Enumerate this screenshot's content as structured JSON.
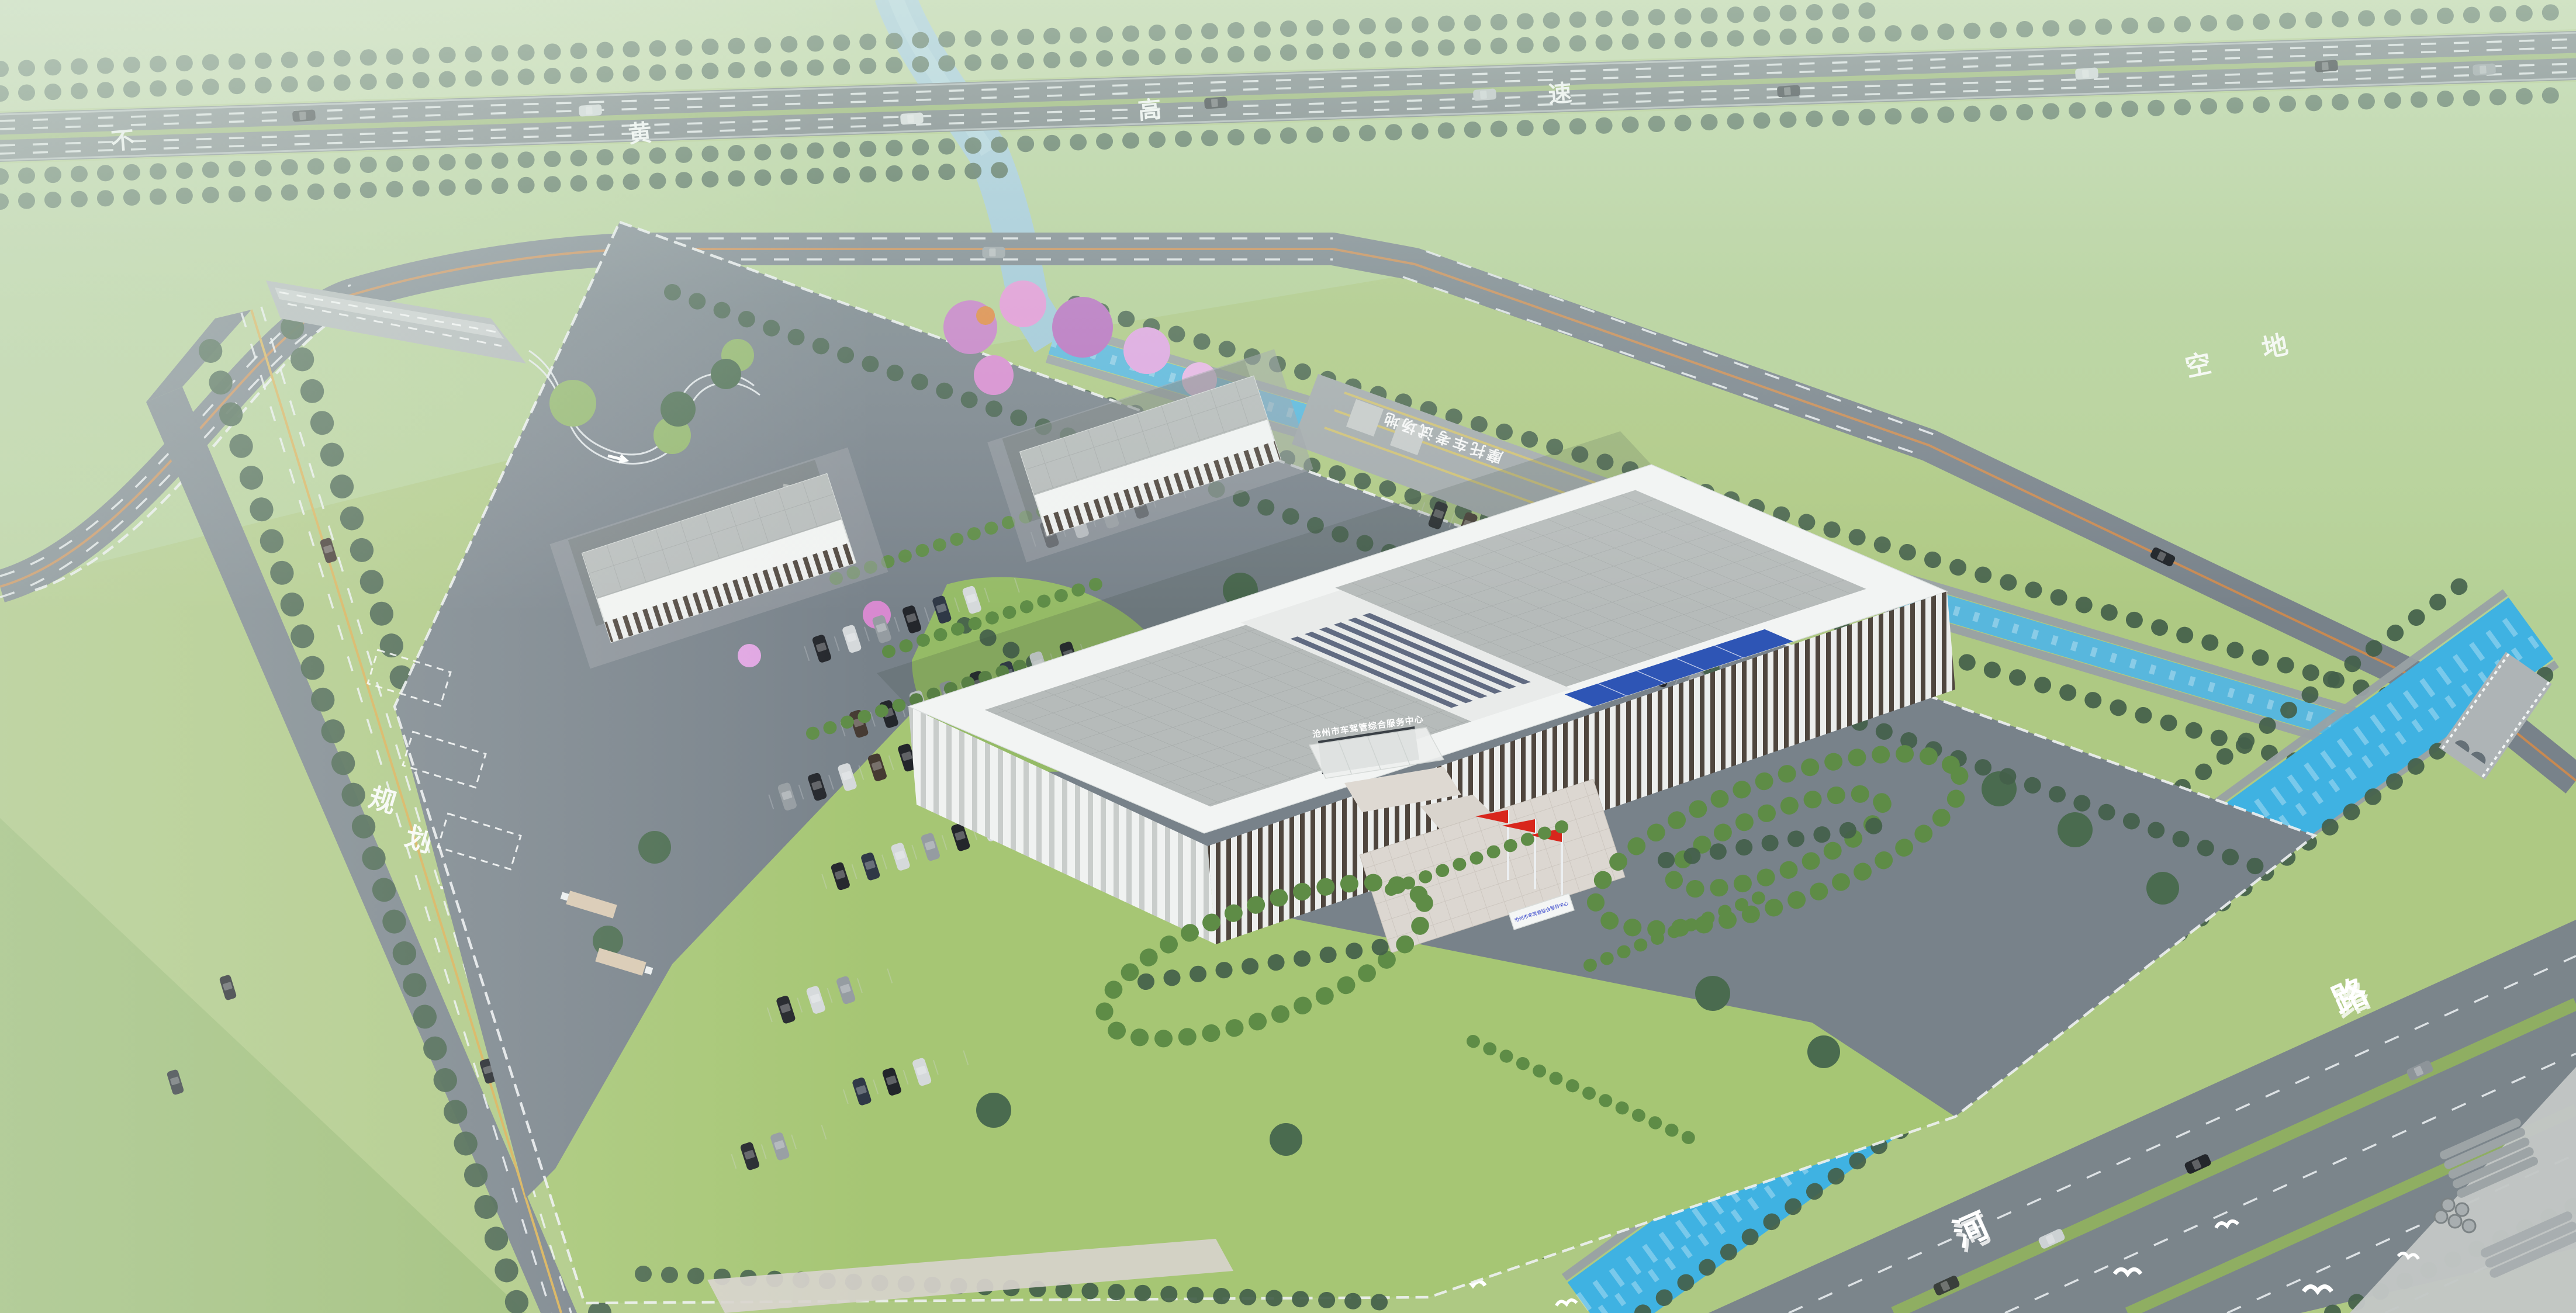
{
  "labels": {
    "highway": {
      "full": "不黄高速",
      "chars": [
        "不",
        "黄",
        "高",
        "速"
      ]
    },
    "planned_branch_road": {
      "full": "规划支路",
      "chars": [
        "规",
        "划",
        "支",
        "路"
      ]
    },
    "river_road": {
      "chars": [
        "河",
        "路"
      ]
    },
    "vacant_land": {
      "full": "空地",
      "chars": [
        "空",
        "地"
      ]
    },
    "building_sign": "沧州市车驾管综合服务中心",
    "gate_nameplate": "沧州市车驾管综合服务中心",
    "motorcycle_test_ground": "摩托车考试场地"
  },
  "colors": {
    "field": "#aec983",
    "field_light": "#bcd49c",
    "field_ne": "#b4d095",
    "lawn": "#a6c674",
    "island": "#95bb66",
    "asphalt": "#78828a",
    "pad": "#a3aaac",
    "concrete": "#c3c7c6",
    "road": "#7b858b",
    "water": "#3fb2e2",
    "water_pale": "#9fc8da",
    "stone": "#99a1a4",
    "tree": "#43604a",
    "bush": "#5e8c46",
    "median": "#8fae62",
    "building_white": "#f2f4f3",
    "roof_gray": "#b6bbba",
    "louver_dark": "#4f463e",
    "sign_blue": "#1828d8",
    "glass_blue": "#2e55b5",
    "flag_red": "#d8261c",
    "blossom": "#c77fc7",
    "blossom_light": "#e596d8",
    "lane_white": "#eef2f4",
    "lane_yellow": "#d8b054",
    "lane_orange": "#d08a4a",
    "fence": "#eef1f2",
    "plaza": "#dcd7d1",
    "canopy_tan": "#d9c9b2"
  }
}
